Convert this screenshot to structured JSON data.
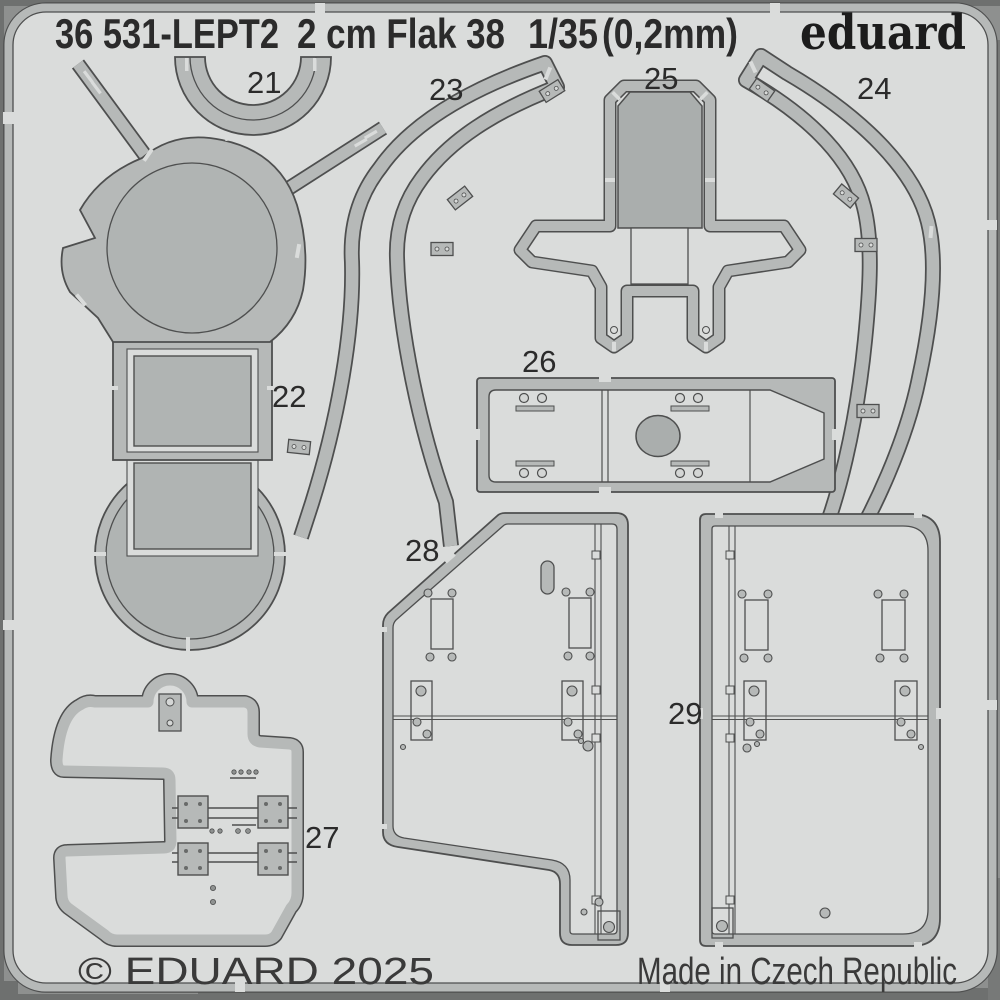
{
  "header": {
    "sheet_code": "36 531-LEPT2",
    "product_name": "2 cm Flak 38",
    "scale": "1/35",
    "thickness": "(0,2mm)",
    "brand": "eduard"
  },
  "footer": {
    "copyright": "© EDUARD 2025",
    "origin": "Made in Czech Republic"
  },
  "parts": [
    {
      "number": "21"
    },
    {
      "number": "22"
    },
    {
      "number": "23"
    },
    {
      "number": "24"
    },
    {
      "number": "25"
    },
    {
      "number": "26"
    },
    {
      "number": "27"
    },
    {
      "number": "28"
    },
    {
      "number": "29"
    }
  ],
  "colors": {
    "background": "#8e908f",
    "edge_dark": "#6e706f",
    "sheet": "#dadcdb",
    "metal": "#b6b9b8",
    "metal_dark": "#aaaead",
    "outline": "#4e4f4f",
    "text": "#2b2b2b"
  }
}
